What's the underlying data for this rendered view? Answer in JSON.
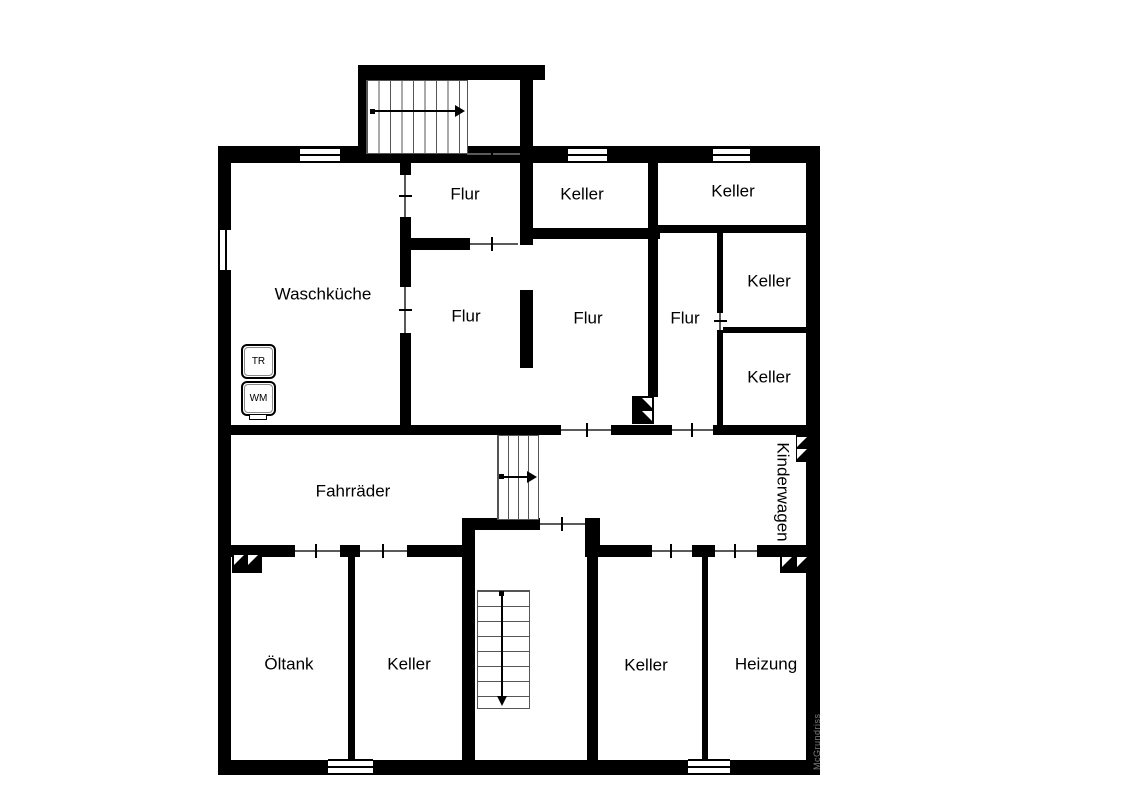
{
  "plan": {
    "watermark": "McGrundriss",
    "rooms": [
      {
        "label": "Flur"
      },
      {
        "label": "Keller"
      },
      {
        "label": "Keller"
      },
      {
        "label": "Waschküche"
      },
      {
        "label": "Flur"
      },
      {
        "label": "Flur"
      },
      {
        "label": "Flur"
      },
      {
        "label": "Keller"
      },
      {
        "label": "Keller"
      },
      {
        "label": "Fahrräder"
      },
      {
        "label": "Kinderwagen"
      },
      {
        "label": "Öltank"
      },
      {
        "label": "Keller"
      },
      {
        "label": "Keller"
      },
      {
        "label": "Heizung"
      }
    ],
    "appliances": [
      {
        "label": "TR"
      },
      {
        "label": "WM"
      }
    ],
    "colors": {
      "wall": "#000000",
      "background": "#ffffff",
      "watermark": "#7d7d7d"
    }
  }
}
